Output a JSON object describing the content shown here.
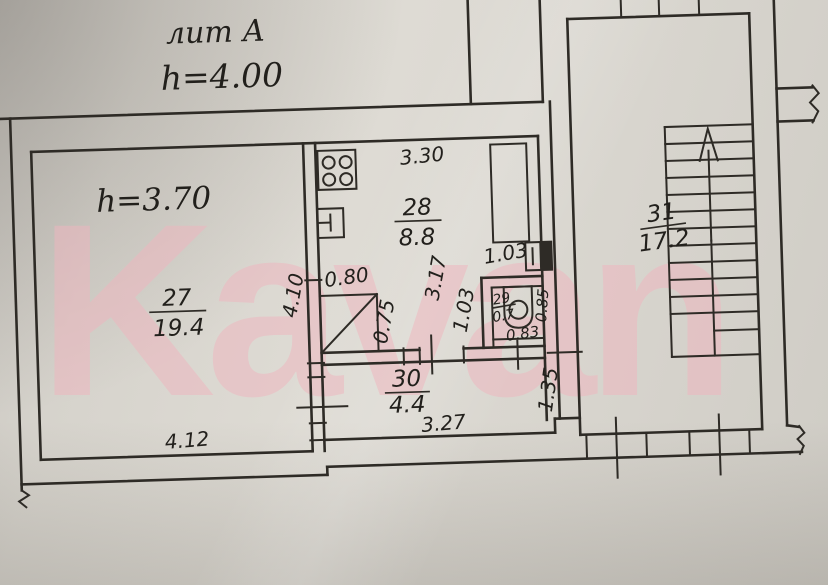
{
  "header": {
    "liter_label": "лит А",
    "floor_height": "h=4.00"
  },
  "watermark": {
    "text": "Kavan",
    "color": "#efb6bf"
  },
  "plan": {
    "ceiling_height_note": "h=3.70",
    "rooms": {
      "r27": {
        "number": "27",
        "area": "19.4"
      },
      "r28": {
        "number": "28",
        "area": "8.8"
      },
      "r29": {
        "number": "29",
        "area": "0.7"
      },
      "r30": {
        "number": "30",
        "area": "4.4"
      },
      "r31": {
        "number": "31",
        "area": "17.2"
      }
    },
    "dims": {
      "kitchen_width": "3.30",
      "kitchen_depth": "3.17",
      "closet_width": "0.80",
      "closet_depth": "0.75",
      "room27_wall": "4.10",
      "niche_width": "1.03",
      "bath_left": "1.03",
      "bath_right": "0.85",
      "bath_bottom": "0.83",
      "room27_bottom": "4.12",
      "hall_bottom": "3.27",
      "hall_right": "1.35"
    },
    "colors": {
      "ink": "#2e2b26",
      "paper": "#d8d4cd"
    }
  }
}
